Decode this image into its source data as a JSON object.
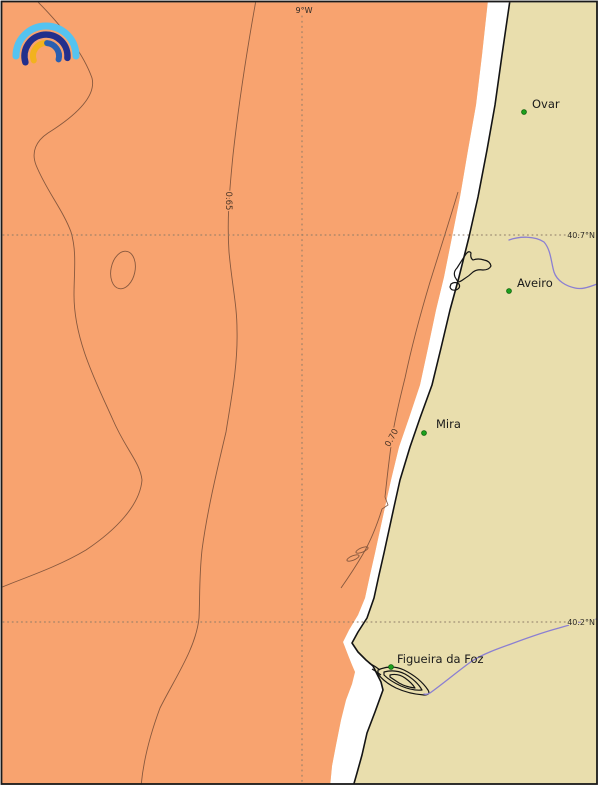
{
  "map": {
    "graticule": {
      "meridian_label": "9°W",
      "parallel_labels": [
        "40.7°N",
        "40.2°N"
      ]
    },
    "contour_labels": [
      "0.65",
      "0.70"
    ],
    "cities": [
      {
        "name": "Ovar",
        "marker": "green-dot",
        "x": 524,
        "y": 112
      },
      {
        "name": "Aveiro",
        "marker": "green-dot",
        "x": 509,
        "y": 291
      },
      {
        "name": "Mira",
        "marker": "green-dot",
        "x": 424,
        "y": 433
      },
      {
        "name": "Figueira da Foz",
        "marker": "green-dot",
        "x": 391,
        "y": 667
      }
    ],
    "colors": {
      "sea": "#F8A36F",
      "land": "#E9DEAD",
      "coastal_strip": "#FFFFFF",
      "coastline": "#141414",
      "contour": "#7A5038",
      "graticule": "#8C7A66",
      "river": "#8B7FD2",
      "city_marker": "#1CA01C",
      "city_marker_edge": "#0A5F0A",
      "label_text": "#1A1A1A",
      "frame": "#1A1A1A",
      "logo_light_blue": "#55C3F0",
      "logo_navy": "#232F8C",
      "logo_blue": "#2B5FB0",
      "logo_yellow": "#F2B21E"
    },
    "logo_icon": "rainbow-arcs-logo"
  }
}
